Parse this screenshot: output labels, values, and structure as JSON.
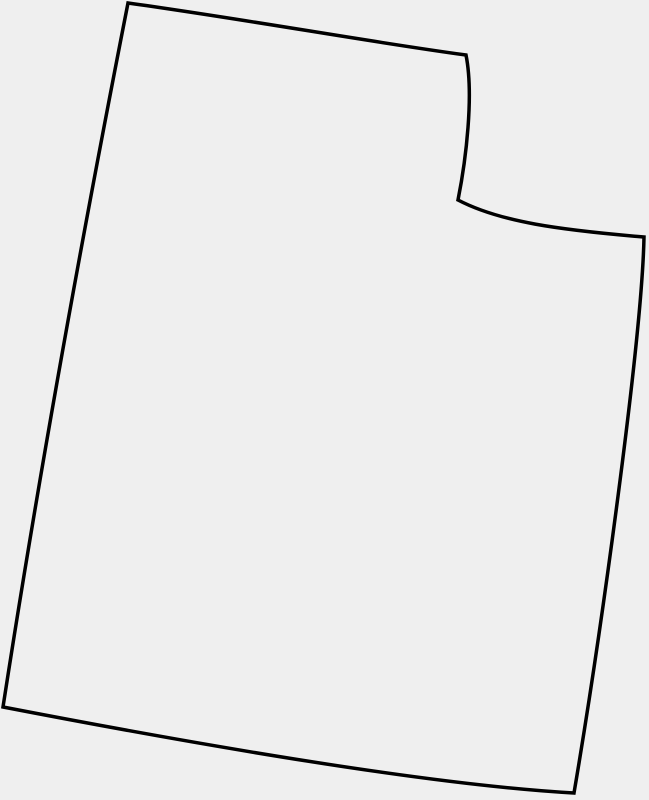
{
  "map": {
    "name": "Utah state outline",
    "region": "Utah",
    "description": "Blank hand-drawn style outline of the U.S. state of Utah with the characteristic northeast rectangular notch; no labels, text, or markers.",
    "outline_path": "M 128 3 C 250 20 370 42 466 55 C 474 95 466 160 458 200 C 500 222 560 230 644 237 C 642 340 600 640 574 793 C 430 785 200 745 3 707 Q 52 390 128 3 Z",
    "stroke_color": "#000000",
    "stroke_width": 3.5,
    "fill_color": "#efefef"
  },
  "colors": {
    "background": "#efefef"
  }
}
